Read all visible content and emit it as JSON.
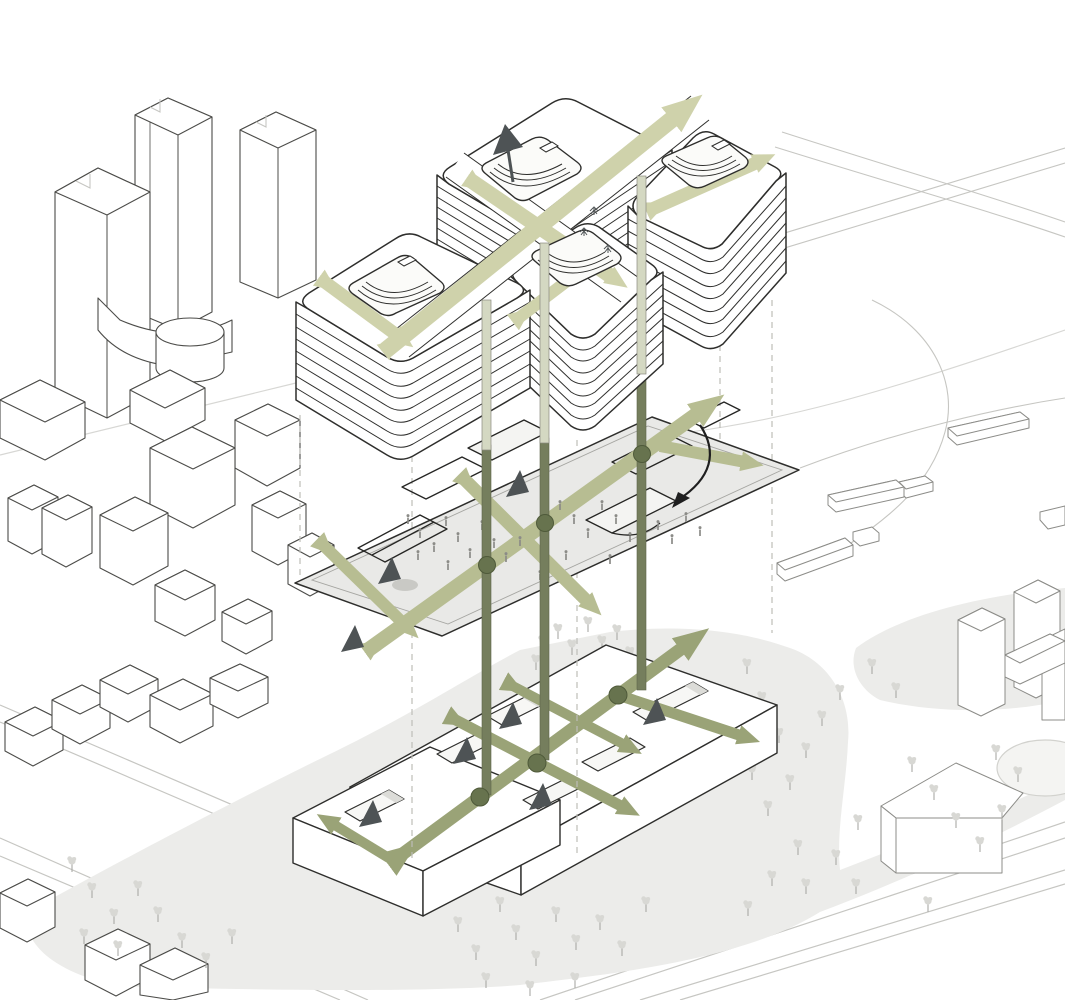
{
  "diagram": {
    "kind": "architectural axonometric circulation diagram",
    "levels": [
      "tower-mass",
      "concourse-plate",
      "ground-podium"
    ]
  },
  "colors": {
    "paper": "#ffffff",
    "ink": "#2e2e2c",
    "context_line": "#4c4c49",
    "far_line": "#8c8c88",
    "faint_line": "#c6c6c2",
    "dash_line": "#bdbdb8",
    "patch": "#ececea",
    "tree": "#d8d8d4",
    "tree_stem": "#a9a9a5",
    "plate": "#e9e9e7",
    "arrow_light": "#cfd2ab",
    "arrow_mid": "#b7bd92",
    "arrow_deep": "#9aa377",
    "column": "#757e5d",
    "column_light": "#d4d8c2",
    "node": "#67734e",
    "wedge": "#4e5355",
    "people": "#8b8b87"
  }
}
